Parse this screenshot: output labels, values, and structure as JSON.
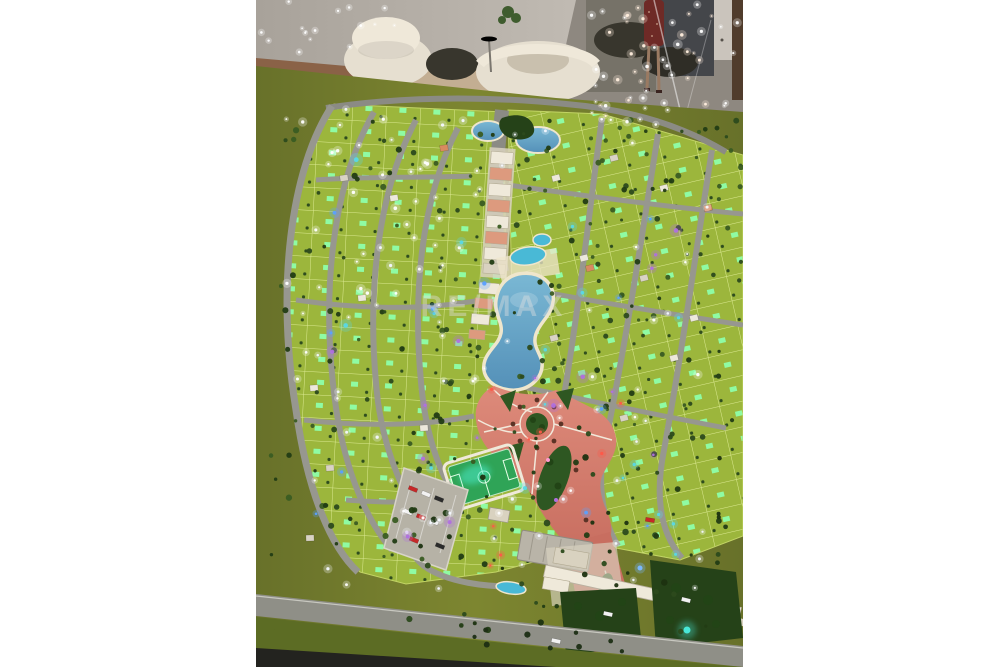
{
  "watermark": {
    "text": "RE/MAX"
  },
  "colors": {
    "page_bg": "#ffffff",
    "wall": "#a8a29a",
    "wall_light": "#cdc7bf",
    "wood": "#8a6247",
    "rug": "#c3ae92",
    "floor": "#8e8880",
    "floor_dark": "#503c2c",
    "panel_dark": "#44464a",
    "panel_mid": "#767268",
    "door": "#cac4bc",
    "cream": "#e6dfd0",
    "cream_hi": "#efe8d9",
    "cream_shadow": "#c9c0ae",
    "furn_dark": "#38362d",
    "plant": "#3f5c2e",
    "dress": "#6e2a26",
    "skin": "#9a7a62",
    "felt": "#7d8630",
    "felt_edge": "#68712a",
    "lot_green": "#9cb63c",
    "lot_line": "#dcea92",
    "glow_green": "#8effa8",
    "street": "#97978f",
    "street_major": "#8b8b84",
    "water": "#5490b8",
    "water_light": "#7ab8d4",
    "pool": "#49b9d6",
    "rim": "#efe6cc",
    "plaza": "#c86e60",
    "plaza_light": "#dd8a7a",
    "plaza_line": "#f2e8da",
    "island": "#2e5722",
    "island_dark": "#224416",
    "pitch": "#2fa457",
    "pitch_glow": "#49e8c6",
    "parking": "#b6b2a6",
    "parking_line": "#d8d4c8",
    "roof_white": "#efe9da",
    "roof_shade": "#d9d2c0",
    "salmon": "#dd9a7e",
    "building_gray": "#b9b4a8",
    "garden": "#254218",
    "glow_teal": "#49e8d8",
    "road_perim": "#8f8f87",
    "grass_dark": "#5c6c24",
    "edge_dark": "#23231f",
    "palm": "#5c3326",
    "watermark": "rgba(225,225,225,0.42)"
  },
  "decorations": {
    "seed": 9,
    "scatters": [
      {
        "name": "trees-left",
        "region": [
          15,
          115,
          235,
          445
        ],
        "count": 92,
        "rmin": 1.6,
        "rmax": 3.2,
        "colors": [
          "#2c4a1c",
          "#3a5c22",
          "#223c14"
        ],
        "glow": false
      },
      {
        "name": "trees-right",
        "region": [
          255,
          118,
          230,
          322
        ],
        "count": 112,
        "rmin": 1.5,
        "rmax": 3.0,
        "colors": [
          "#2c4a1c",
          "#3a5c22",
          "#223c14"
        ],
        "glow": false
      },
      {
        "name": "trees-south",
        "region": [
          150,
          445,
          320,
          190
        ],
        "count": 62,
        "rmin": 1.6,
        "rmax": 3.4,
        "colors": [
          "#223c14",
          "#2c4a1c",
          "#1c3210"
        ],
        "glow": false
      },
      {
        "name": "trees-road",
        "region": [
          200,
          628,
          185,
          30
        ],
        "count": 9,
        "rmin": 2.0,
        "rmax": 3.2,
        "colors": [
          "#1c2e14"
        ],
        "glow": false
      },
      {
        "name": "glass-sparkles",
        "region": [
          330,
          0,
          155,
          122
        ],
        "count": 55,
        "rmin": 0.7,
        "rmax": 1.8,
        "colors": [
          "#ffffff",
          "#ffeedd"
        ],
        "glow": true
      },
      {
        "name": "wall-sparkles",
        "region": [
          0,
          0,
          150,
          55
        ],
        "count": 16,
        "rmin": 0.6,
        "rmax": 1.4,
        "colors": [
          "#ffffff"
        ],
        "glow": true
      },
      {
        "name": "street-lights",
        "region": [
          25,
          108,
          445,
          482
        ],
        "count": 85,
        "rmin": 0.9,
        "rmax": 1.7,
        "colors": [
          "#ffffff",
          "#f4f8ff"
        ],
        "glow": true
      },
      {
        "name": "lights-upper-left",
        "region": [
          20,
          115,
          170,
          190
        ],
        "count": 22,
        "rmin": 1.0,
        "rmax": 1.9,
        "colors": [
          "#ffffff"
        ],
        "glow": true
      },
      {
        "name": "led-blue",
        "region": [
          60,
          140,
          380,
          440
        ],
        "count": 42,
        "rmin": 1.2,
        "rmax": 2.4,
        "colors": [
          "#5aa0ff",
          "#58d8e8",
          "#b070e0"
        ],
        "glow": true
      },
      {
        "name": "led-red",
        "region": [
          215,
          385,
          170,
          210
        ],
        "count": 8,
        "rmin": 1.2,
        "rmax": 2.0,
        "colors": [
          "#ff5748"
        ],
        "glow": true
      }
    ],
    "houses": {
      "colors": [
        "#ece8dc",
        "#d9d3c5",
        "#d88a60"
      ],
      "w": 8,
      "h": 6,
      "items": [
        [
          58,
          388,
          -4,
          0
        ],
        [
          74,
          468,
          -4,
          1
        ],
        [
          106,
          298,
          -6,
          0
        ],
        [
          138,
          198,
          -8,
          0
        ],
        [
          88,
          178,
          -8,
          1
        ],
        [
          168,
          428,
          -4,
          0
        ],
        [
          54,
          538,
          -2,
          1
        ],
        [
          300,
          178,
          -14,
          0
        ],
        [
          358,
          158,
          -14,
          1
        ],
        [
          408,
          188,
          -14,
          0
        ],
        [
          328,
          258,
          -14,
          0
        ],
        [
          388,
          278,
          -14,
          1
        ],
        [
          438,
          318,
          -14,
          0
        ],
        [
          298,
          338,
          -14,
          1
        ],
        [
          418,
          358,
          -14,
          0
        ],
        [
          368,
          418,
          -14,
          1
        ],
        [
          334,
          268,
          -14,
          2
        ],
        [
          452,
          208,
          -14,
          2
        ],
        [
          188,
          148,
          -8,
          2
        ]
      ]
    },
    "cars": {
      "colors": [
        "#c62828",
        "#f2f2f2",
        "#2b2b2b"
      ],
      "w": 9,
      "h": 4,
      "items": [
        [
          157,
          489,
          22,
          0
        ],
        [
          170,
          494,
          22,
          1
        ],
        [
          183,
          499,
          22,
          2
        ],
        [
          152,
          512,
          22,
          1
        ],
        [
          165,
          517,
          22,
          0
        ],
        [
          178,
          522,
          22,
          1
        ],
        [
          158,
          540,
          22,
          0
        ],
        [
          184,
          546,
          22,
          2
        ],
        [
          394,
          520,
          10,
          0
        ],
        [
          300,
          641,
          12,
          1
        ],
        [
          352,
          614,
          12,
          1
        ],
        [
          430,
          600,
          14,
          1
        ]
      ]
    }
  }
}
